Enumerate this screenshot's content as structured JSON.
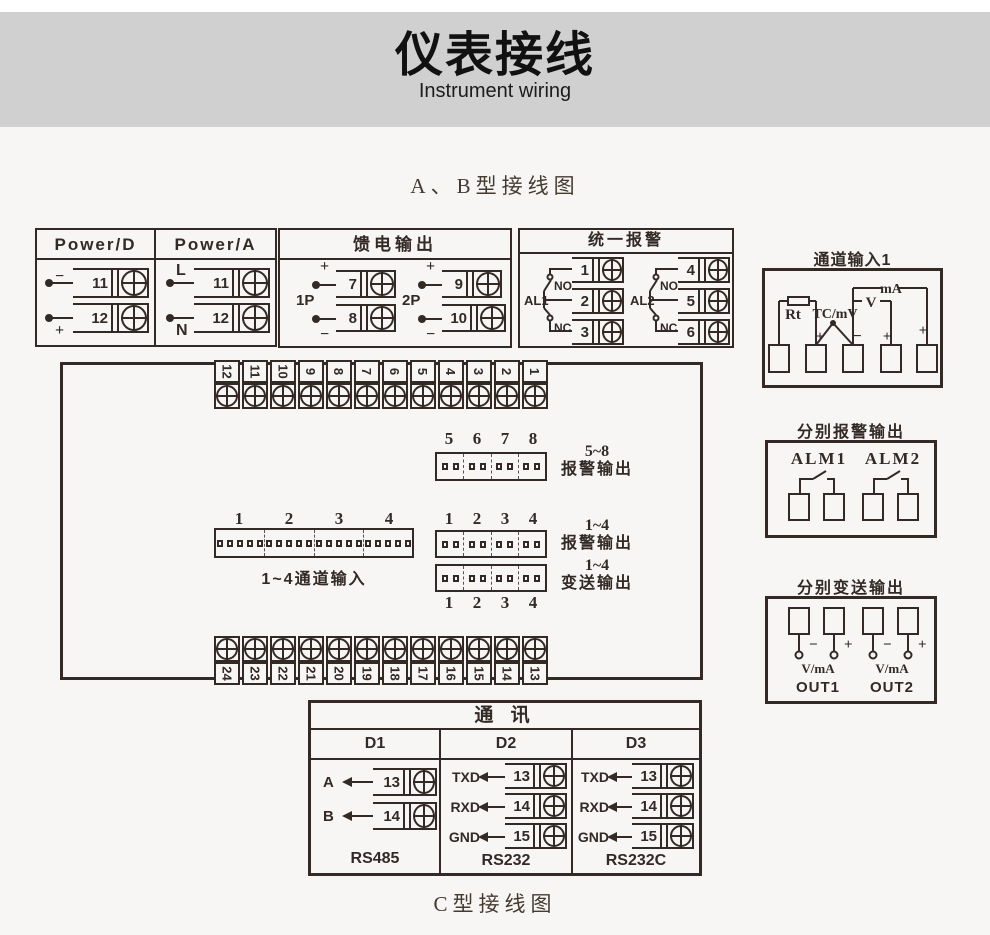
{
  "page": {
    "title": "仪表接线",
    "subtitle": "Instrument wiring",
    "section_ab": "A、B型接线图",
    "section_c": "C型接线图"
  },
  "power_block": {
    "headers": [
      "Power/D",
      "Power/A"
    ],
    "groups": [
      {
        "t1_label": "−",
        "t1_num": "11",
        "t2_label": "+",
        "t2_num": "12"
      },
      {
        "t1_label": "L",
        "t1_num": "11",
        "t2_label": "N",
        "t2_num": "12"
      }
    ]
  },
  "feed_block": {
    "title": "馈电输出",
    "groups": [
      {
        "name": "1P",
        "plus": "+",
        "plus_num": "7",
        "minus": "−",
        "minus_num": "8"
      },
      {
        "name": "2P",
        "plus": "+",
        "plus_num": "9",
        "minus": "−",
        "minus_num": "10"
      }
    ]
  },
  "unified_alarm": {
    "title": "统一报警",
    "groups": [
      {
        "name": "AL1",
        "no": "NO",
        "nc": "NC",
        "nums": [
          "1",
          "2",
          "3"
        ]
      },
      {
        "name": "AL2",
        "no": "NO",
        "nc": "NC",
        "nums": [
          "4",
          "5",
          "6"
        ]
      }
    ]
  },
  "channel_input": {
    "title": "通道输入1",
    "rt": "Rt",
    "tc": "TC/mV",
    "v": "V",
    "ma": "mA",
    "t2_sign": "+",
    "t3_sign": "−",
    "t4_sign": "+",
    "t5_sign": "+"
  },
  "main_block": {
    "top_terminals": [
      "12",
      "11",
      "10",
      "9",
      "8",
      "7",
      "6",
      "5",
      "4",
      "3",
      "2",
      "1"
    ],
    "bottom_terminals": [
      "24",
      "23",
      "22",
      "21",
      "20",
      "19",
      "18",
      "17",
      "16",
      "15",
      "14",
      "13"
    ],
    "alarm58": {
      "nums": [
        "5",
        "6",
        "7",
        "8"
      ],
      "range": "5~8",
      "label": "报警输出"
    },
    "channel14": {
      "nums": [
        "1",
        "2",
        "3",
        "4"
      ],
      "label": "1~4通道输入"
    },
    "alarm14": {
      "nums": [
        "1",
        "2",
        "3",
        "4"
      ],
      "range": "1~4",
      "label": "报警输出"
    },
    "trans14": {
      "nums": [
        "1",
        "2",
        "3",
        "4"
      ],
      "range": "1~4",
      "label": "变送输出"
    }
  },
  "sep_alarm": {
    "title": "分别报警输出",
    "names": [
      "ALM1",
      "ALM2"
    ]
  },
  "sep_trans": {
    "title": "分别变送输出",
    "minus": "−",
    "plus": "+",
    "vma": "V/mA",
    "outs": [
      "OUT1",
      "OUT2"
    ]
  },
  "comm": {
    "title": "通  讯",
    "columns": [
      {
        "name": "D1",
        "proto": "RS485",
        "rows": [
          {
            "sig": "A",
            "num": "13"
          },
          {
            "sig": "B",
            "num": "14"
          }
        ]
      },
      {
        "name": "D2",
        "proto": "RS232",
        "rows": [
          {
            "sig": "TXD",
            "num": "13"
          },
          {
            "sig": "RXD",
            "num": "14"
          },
          {
            "sig": "GND",
            "num": "15"
          }
        ]
      },
      {
        "name": "D3",
        "proto": "RS232C",
        "rows": [
          {
            "sig": "TXD",
            "num": "13"
          },
          {
            "sig": "RXD",
            "num": "14"
          },
          {
            "sig": "GND",
            "num": "15"
          }
        ]
      }
    ]
  }
}
